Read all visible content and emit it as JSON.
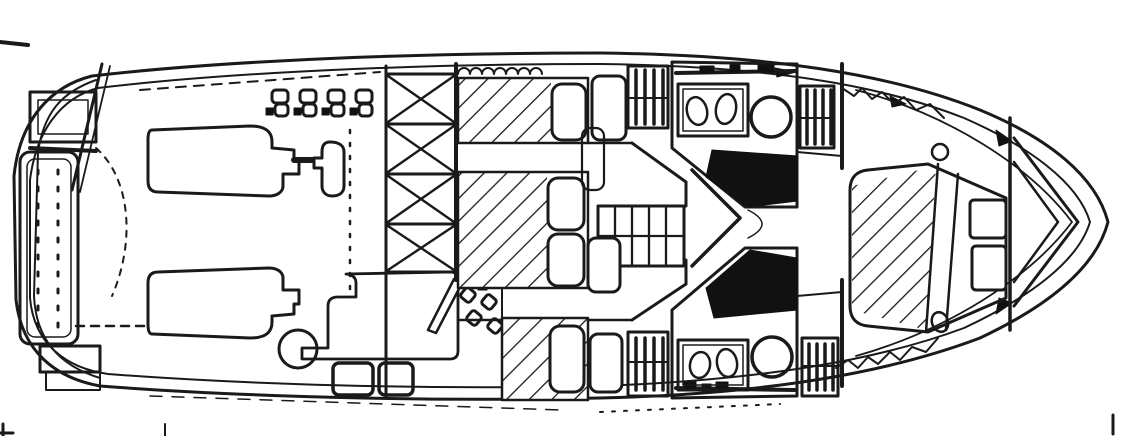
{
  "figure": {
    "type": "boat-floor-plan",
    "description": "Black and white line-art deck plan of a twin-engine motor yacht, stern and cockpit at left, twin heads amidships, V-berth at the pointed bow on the right",
    "regions": [
      {
        "id": "hull-outline",
        "meaning": "outer and inner hull sheer lines"
      },
      {
        "id": "swim-gate",
        "meaning": "transom boarding gate and ladder"
      },
      {
        "id": "transom-bench",
        "meaning": "stitched cockpit bench along transom"
      },
      {
        "id": "port-engine",
        "meaning": "port engine block"
      },
      {
        "id": "starboard-engine",
        "meaning": "starboard engine block"
      },
      {
        "id": "engine-control",
        "meaning": "engine control linkage"
      },
      {
        "id": "cockpit-fittings",
        "meaning": "deck hardware cleats row"
      },
      {
        "id": "deck-hatch-circle",
        "meaning": "round deck hatch"
      },
      {
        "id": "crosshatch-ladder",
        "meaning": "cross-hatched companionway / engine hatch strip"
      },
      {
        "id": "salon-berth-aft",
        "meaning": "hatched settee berth, aft port"
      },
      {
        "id": "salon-berth-mid",
        "meaning": "hatched settee berth, midship"
      },
      {
        "id": "salon-berth-fwd",
        "meaning": "hatched settee berth, starboard"
      },
      {
        "id": "galley-counter",
        "meaning": "galley counter"
      },
      {
        "id": "stove-burners",
        "meaning": "four-burner stove"
      },
      {
        "id": "cockpit-steps",
        "meaning": "moulded cockpit steps"
      },
      {
        "id": "companionway-steps",
        "meaning": "central stair grid to forward cabin"
      },
      {
        "id": "head-port",
        "meaning": "port head with vanity, toilet and black shower stall"
      },
      {
        "id": "head-starboard",
        "meaning": "starboard head with vanity, toilet and black shower stall"
      },
      {
        "id": "hanging-lockers",
        "meaning": "hanging lockers shown with rod-and-hanger bars"
      },
      {
        "id": "v-berth",
        "meaning": "hatched V-berth at bow"
      },
      {
        "id": "bow-lockers",
        "meaning": "bow stowage boxes"
      },
      {
        "id": "register-ticks",
        "meaning": "small print registration ticks at page edges"
      }
    ]
  },
  "colors": {
    "ink": "#111111",
    "line": "#1a1a1a",
    "paper": "#ffffff"
  },
  "canvas": {
    "width": 1131,
    "height": 436
  }
}
